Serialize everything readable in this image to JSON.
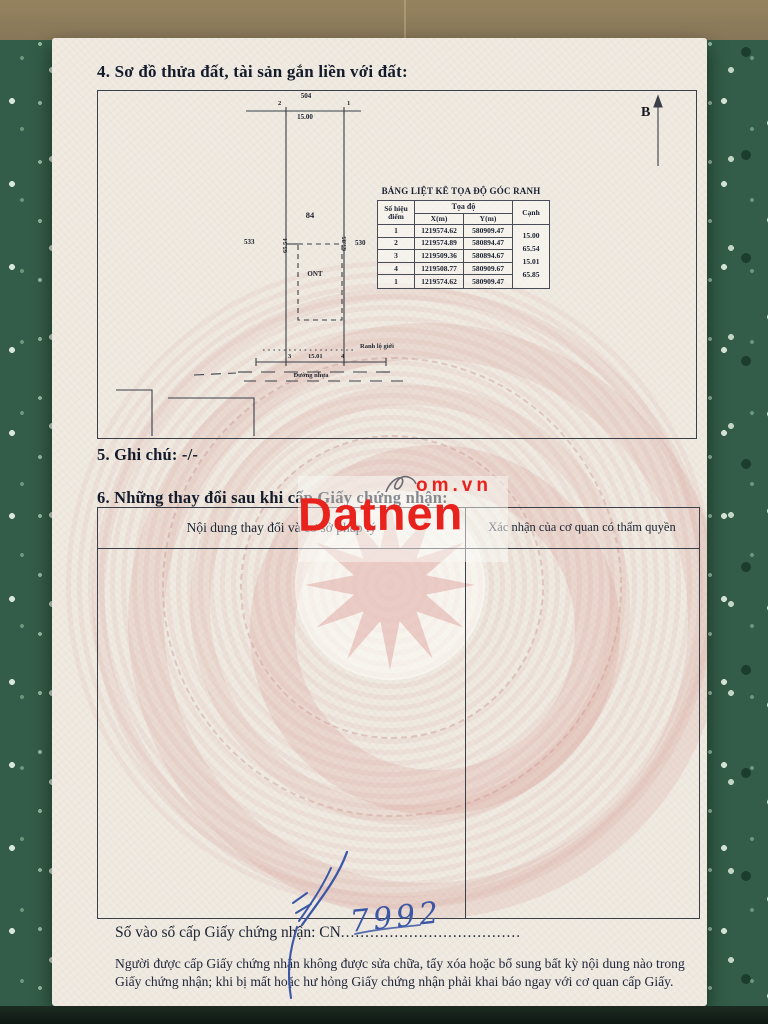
{
  "document": {
    "section4_title": "4. Sơ đồ thửa đất, tài sản gắn liền với đất:",
    "section5_title": "5. Ghi chú: -/-",
    "section6_title": "6. Những thay đổi sau khi cấp Giấy chứng nhận:"
  },
  "diagram": {
    "north_label": "B",
    "parcel_number": "84",
    "neighbor_top": "504",
    "neighbor_left": "533",
    "neighbor_right": "530",
    "length_top": "15.00",
    "length_left": "65.54",
    "length_right": "65.85",
    "length_bottom": "15.01",
    "point_top_left": "2",
    "point_top_right": "1",
    "point_bottom_left": "3",
    "point_bottom_right": "4",
    "land_use_code": "ONT",
    "setback_label": "Ranh lộ giới",
    "road_label": "Đường nhựa"
  },
  "coord_table": {
    "title": "BẢNG LIỆT KÊ TỌA ĐỘ GÓC RANH",
    "headers": {
      "point": "Số hiệu điểm",
      "coords": "Tọa độ",
      "x": "X(m)",
      "y": "Y(m)",
      "edge": "Cạnh"
    },
    "rows": [
      {
        "point": "1",
        "x": "1219574.62",
        "y": "580909.47"
      },
      {
        "point": "2",
        "x": "1219574.89",
        "y": "580894.47"
      },
      {
        "point": "3",
        "x": "1219509.36",
        "y": "580894.67"
      },
      {
        "point": "4",
        "x": "1219508.77",
        "y": "580909.67"
      },
      {
        "point": "1",
        "x": "1219574.62",
        "y": "580909.47"
      }
    ],
    "edges": [
      "15.00",
      "65.54",
      "15.01",
      "65.85"
    ]
  },
  "changes_table": {
    "col1_header": "Nội dung thay đổi và cơ sở pháp lý",
    "col2_header": "Xác nhận của cơ quan có thẩm quyền"
  },
  "watermark": {
    "brand": "Datnen",
    "suffix": "om.vn",
    "color": "#e8231d"
  },
  "serial": {
    "label": "Số vào sổ cấp Giấy chứng nhận: CN",
    "number": "7992",
    "dots": "........................................................"
  },
  "footer": {
    "line1": "Người được cấp Giấy chứng nhận không được sửa chữa, tẩy xóa hoặc bổ sung bất kỳ nội dung nào trong",
    "line2": "Giấy chứng nhận; khi bị mất hoặc hư hỏng Giấy chứng nhận phải khai báo ngay với cơ quan cấp Giấy."
  }
}
